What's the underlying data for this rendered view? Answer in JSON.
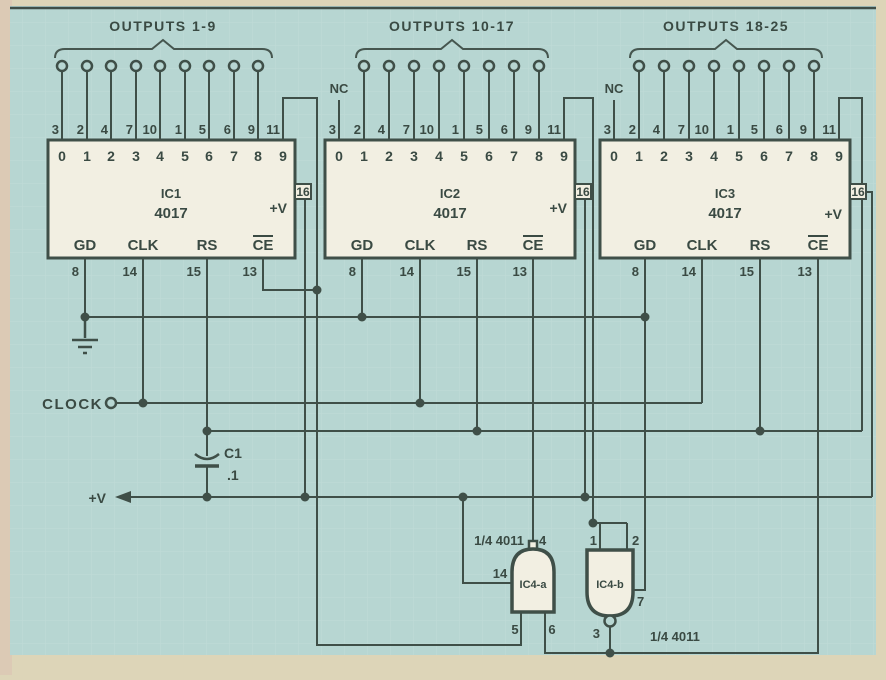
{
  "colors": {
    "page_bg": "#ddd5b8",
    "panel_bg": "#b7d6d2",
    "line": "#3f4f48",
    "ic_fill": "#f2efe2"
  },
  "ics": [
    {
      "name": "IC1",
      "part": "4017",
      "outputs_label": "OUTPUTS 1-9",
      "inner_top": [
        "0",
        "1",
        "2",
        "3",
        "4",
        "5",
        "6",
        "7",
        "8",
        "9"
      ],
      "top_pins": [
        "3",
        "2",
        "4",
        "7",
        "10",
        "1",
        "5",
        "6",
        "9",
        "11"
      ],
      "bottom_labels": [
        "GD",
        "CLK",
        "RS",
        "CE"
      ],
      "bottom_pins": [
        "8",
        "14",
        "15",
        "13"
      ],
      "vplus_label": "+V",
      "vplus_pin": "16"
    },
    {
      "name": "IC2",
      "part": "4017",
      "outputs_label": "OUTPUTS 10-17",
      "nc_label": "NC",
      "inner_top": [
        "0",
        "1",
        "2",
        "3",
        "4",
        "5",
        "6",
        "7",
        "8",
        "9"
      ],
      "top_pins": [
        "3",
        "2",
        "4",
        "7",
        "10",
        "1",
        "5",
        "6",
        "9",
        "11"
      ],
      "bottom_labels": [
        "GD",
        "CLK",
        "RS",
        "CE"
      ],
      "bottom_pins": [
        "8",
        "14",
        "15",
        "13"
      ],
      "vplus_label": "+V",
      "vplus_pin": "16"
    },
    {
      "name": "IC3",
      "part": "4017",
      "outputs_label": "OUTPUTS 18-25",
      "nc_label": "NC",
      "inner_top": [
        "0",
        "1",
        "2",
        "3",
        "4",
        "5",
        "6",
        "7",
        "8",
        "9"
      ],
      "top_pins": [
        "3",
        "2",
        "4",
        "7",
        "10",
        "1",
        "5",
        "6",
        "9",
        "11"
      ],
      "bottom_labels": [
        "GD",
        "CLK",
        "RS",
        "CE"
      ],
      "bottom_pins": [
        "8",
        "14",
        "15",
        "13"
      ],
      "vplus_label": "+V",
      "vplus_pin": "16"
    }
  ],
  "gates": [
    {
      "name": "IC4-a",
      "part_label": "1/4 4011",
      "output_pin": "4",
      "input_pins": [
        "5",
        "6"
      ],
      "power_pin": "14"
    },
    {
      "name": "IC4-b",
      "part_label": "1/4 4011",
      "output_pin": "3",
      "input_pins": [
        "1",
        "2"
      ],
      "power_pin": "7"
    }
  ],
  "misc": {
    "clock_label": "CLOCK",
    "vplus_label": "+V",
    "cap_name": "C1",
    "cap_value": ".1"
  }
}
